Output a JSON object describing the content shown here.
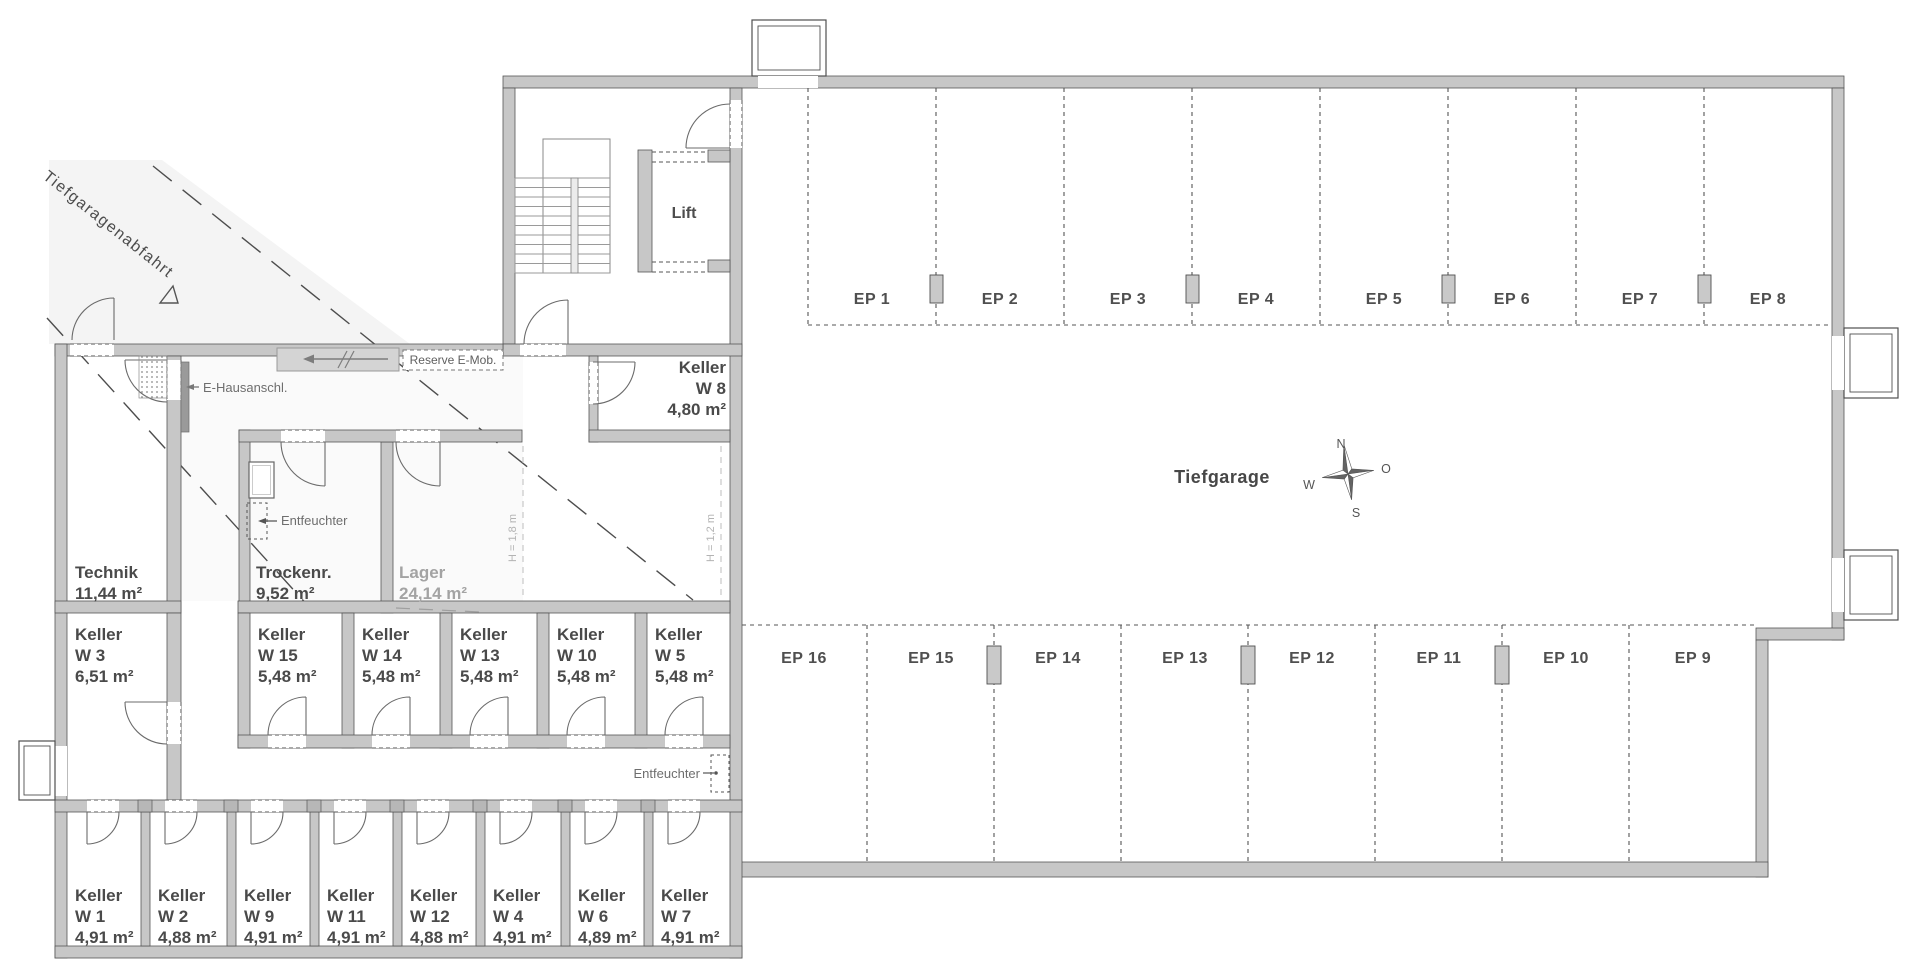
{
  "plan": {
    "ramp_label": "Tiefgaragenabfahrt",
    "garage_label": "Tiefgarage",
    "lift_label": "Lift",
    "compass": {
      "n": "N",
      "e": "O",
      "s": "S",
      "w": "W"
    },
    "annotations": {
      "e_hausanschluss": "E-Hausanschl.",
      "reserve_emob": "Reserve E-Mob.",
      "entfeuchter_trockenraum": "Entfeuchter",
      "entfeuchter_corridor": "Entfeuchter",
      "height_18": "H = 1,8 m",
      "height_12": "H = 1,2 m"
    },
    "rooms": {
      "technik": {
        "name": "Technik",
        "area": "11,44 m²"
      },
      "trockenraum": {
        "name": "Trockenr.",
        "area": "9,52 m²"
      },
      "lager": {
        "name": "Lager",
        "area": "24,14 m²"
      },
      "keller_w8": {
        "name": "Keller",
        "unit": "W 8",
        "area": "4,80 m²"
      },
      "keller_w3": {
        "name": "Keller",
        "unit": "W 3",
        "area": "6,51 m²"
      }
    },
    "keller_row_middle": [
      {
        "name": "Keller",
        "unit": "W 15",
        "area": "5,48 m²"
      },
      {
        "name": "Keller",
        "unit": "W 14",
        "area": "5,48 m²"
      },
      {
        "name": "Keller",
        "unit": "W 13",
        "area": "5,48 m²"
      },
      {
        "name": "Keller",
        "unit": "W 10",
        "area": "5,48 m²"
      },
      {
        "name": "Keller",
        "unit": "W 5",
        "area": "5,48 m²"
      }
    ],
    "keller_row_bottom": [
      {
        "name": "Keller",
        "unit": "W 1",
        "area": "4,91 m²"
      },
      {
        "name": "Keller",
        "unit": "W 2",
        "area": "4,88 m²"
      },
      {
        "name": "Keller",
        "unit": "W 9",
        "area": "4,91 m²"
      },
      {
        "name": "Keller",
        "unit": "W 11",
        "area": "4,91 m²"
      },
      {
        "name": "Keller",
        "unit": "W 12",
        "area": "4,88 m²"
      },
      {
        "name": "Keller",
        "unit": "W 4",
        "area": "4,91 m²"
      },
      {
        "name": "Keller",
        "unit": "W 6",
        "area": "4,89 m²"
      },
      {
        "name": "Keller",
        "unit": "W 7",
        "area": "4,91 m²"
      }
    ],
    "parking_top": [
      {
        "label": "EP 1"
      },
      {
        "label": "EP 2"
      },
      {
        "label": "EP 3"
      },
      {
        "label": "EP 4"
      },
      {
        "label": "EP 5"
      },
      {
        "label": "EP 6"
      },
      {
        "label": "EP 7"
      },
      {
        "label": "EP 8"
      }
    ],
    "parking_bottom": [
      {
        "label": "EP 16"
      },
      {
        "label": "EP 15"
      },
      {
        "label": "EP 14"
      },
      {
        "label": "EP 13"
      },
      {
        "label": "EP 12"
      },
      {
        "label": "EP 11"
      },
      {
        "label": "EP 10"
      },
      {
        "label": "EP 9"
      }
    ],
    "colors": {
      "wall": "#c7c7c7",
      "wall_stroke": "#565656",
      "line": "#555555",
      "light_text": "#a3a3a3",
      "ramp_tint": "#f4f4f4"
    }
  }
}
